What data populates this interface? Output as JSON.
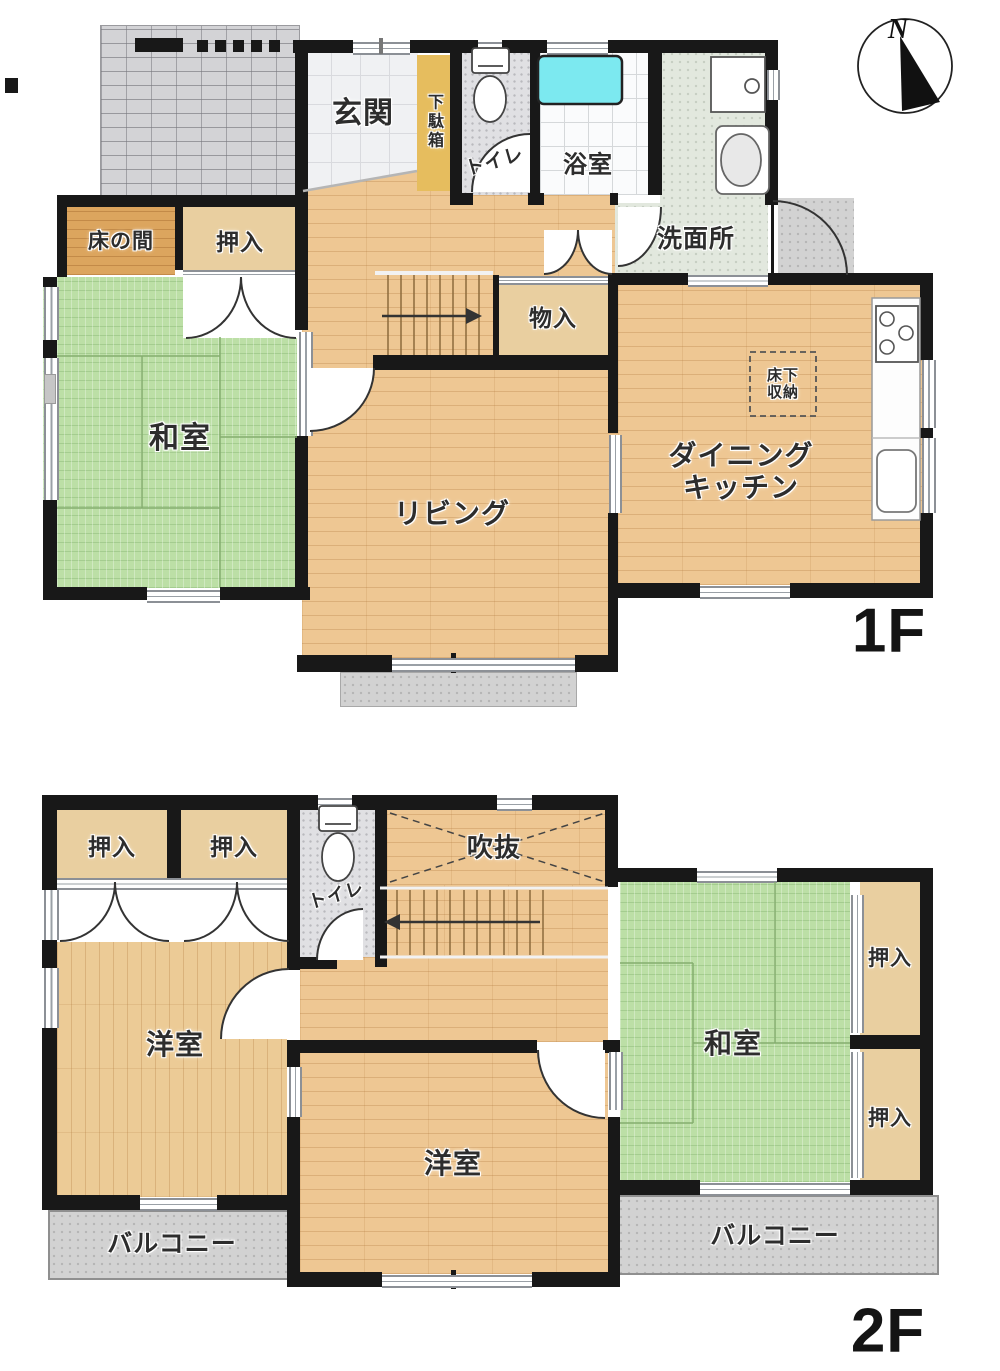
{
  "compass": {
    "north": "N"
  },
  "floor1": {
    "label": "1F",
    "rooms": {
      "entrance": "玄関",
      "shoe_cabinet": "下駄箱",
      "toilet": "トイレ",
      "bathroom": "浴室",
      "washroom": "洗面所",
      "tokonoma": "床の間",
      "closet": "押入",
      "japanese_room": "和室",
      "storage": "物入",
      "living": "リビング",
      "dining_kitchen": [
        "ダイニング",
        "キッチン"
      ],
      "underfloor_storage": [
        "床下",
        "収納"
      ]
    }
  },
  "floor2": {
    "label": "2F",
    "rooms": {
      "closet": "押入",
      "toilet": "トイレ",
      "atrium_void": "吹抜",
      "western_room": "洋室",
      "japanese_room": "和室",
      "balcony": "バルコニー"
    }
  },
  "colors": {
    "wall": "#181818",
    "tatami_green": "#bcdfa6",
    "wood_floor": "#eec793",
    "closet_tan": "#e9cfa0",
    "entrance_tile": "#f0f1f3",
    "bathtub_water": "#7ce9f0",
    "balcony_gray": "#d2d2d2"
  }
}
